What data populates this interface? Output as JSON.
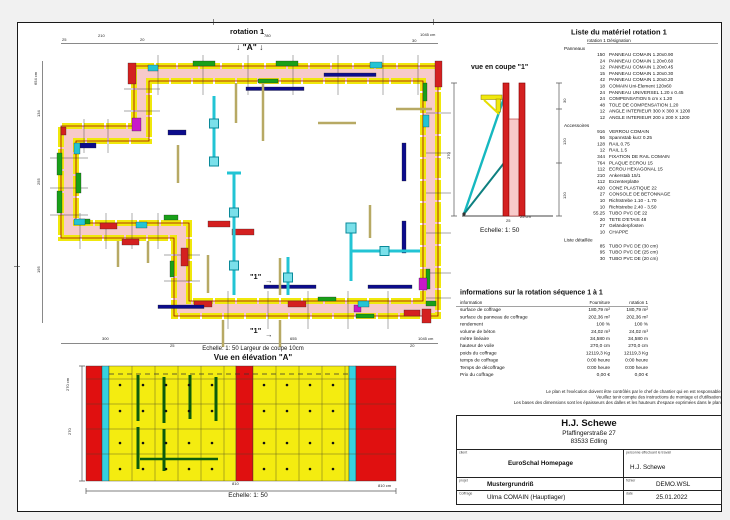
{
  "plan": {
    "title": "rotation 1",
    "marker_a": "↓ \"A\" ↓",
    "cut_marker": "\"1\"",
    "cut_arrow": "→",
    "dims_top": [
      "25",
      "210",
      "20",
      "780",
      "30"
    ],
    "dims_top_total": "1045 cm",
    "dims_left": [
      "134",
      "255",
      "195"
    ],
    "dims_left_total": "654 cm",
    "dims_bottom": [
      "300",
      "25",
      "655",
      "20"
    ],
    "dims_bottom_total": "1045 cm",
    "caption": "Echelle: 1: 50   Largeur de coupe 10cm"
  },
  "section_view": {
    "title": "vue en coupe \"1\"",
    "dims_right": [
      "30",
      "120",
      "120"
    ],
    "dim_left": "270",
    "dim_width": "25",
    "dim_width_label": "25 cm",
    "scale": "Echelle: 1: 50"
  },
  "elevation": {
    "title": "Vue en élévation \"A\"",
    "dim_left_label": "270 cm",
    "dim_left": "270",
    "dim_bottom": "810",
    "dim_bottom_label": "810 cm",
    "scale": "Echelle: 1: 50"
  },
  "material_list": {
    "title": "Liste du matériel  rotation 1",
    "header": "rotation 1   Désignation",
    "sections": [
      {
        "name": "Panneaux",
        "items": [
          [
            "150",
            "PANNEAU COMAIN 1.20x0.90"
          ],
          [
            "24",
            "PANNEAU COMAIN 1.20x0.60"
          ],
          [
            "12",
            "PANNEAU COMAIN 1.20x0.45"
          ],
          [
            "15",
            "PANNEAU COMAIN 1.20x0.30"
          ],
          [
            "42",
            "PANNEAU COMAIN 1.20x0.20"
          ],
          [
            "18",
            "COMAIN Uni-Element 120x60"
          ],
          [
            "24",
            "PANNEAU UNIVERSEL 1.20 x 0.45"
          ],
          [
            "24",
            "COMPENSATION 5 cm x 1.20"
          ],
          [
            "48",
            "TOLE DE COMPENSATION 1.20"
          ],
          [
            "12",
            "ANGLE INTERIEUR 300 X 300 X 1200"
          ],
          [
            "12",
            "ANGLE INTERIEUR 200 x 200 X 1200"
          ]
        ]
      },
      {
        "name": "Accessoires",
        "items": [
          [
            "916",
            "VERROU COMAIN"
          ],
          [
            "56",
            "Spannstab kurz 0.25"
          ],
          [
            "128",
            "RAIL 0.75"
          ],
          [
            "12",
            "RAIL 1.5"
          ],
          [
            "344",
            "FIXATION DE RAIL COMAIN"
          ],
          [
            "764",
            "PLAQUE ECROU 15"
          ],
          [
            "112",
            "ECROU HEXAGONAL 15"
          ],
          [
            "210",
            "Ankerstab 15/1"
          ],
          [
            "112",
            "Exzenterplatte"
          ],
          [
            "420",
            "CONE PLASTIQUE 22"
          ],
          [
            "27",
            "CONSOLE DE BETONNAGE"
          ],
          [
            "10",
            "Richtstrebe 1.10 - 1.70"
          ],
          [
            "10",
            "Richtstrebe 2.40 - 3.50"
          ],
          [
            "55.25",
            "TUBO PVC DE 22"
          ],
          [
            "20",
            "TETE D'ETAIS 48"
          ],
          [
            "27",
            "Geländerpfosten"
          ],
          [
            "10",
            "CHAPPE"
          ]
        ]
      },
      {
        "name": "Liste détaillée",
        "items": [
          [
            "85",
            "TUBO PVC DE  (30 cm)"
          ],
          [
            "95",
            "TUBO PVC DE  (25 cm)"
          ],
          [
            "30",
            "TUBO PVC DE  (20 cm)"
          ]
        ]
      }
    ]
  },
  "info_table": {
    "title": "informations sur la rotation  séquence 1 à 1",
    "columns": [
      "information",
      "Fourniture",
      "rotation 1"
    ],
    "rows": [
      [
        "surface de coffrage",
        "180,79 m²",
        "180,79 m²"
      ],
      [
        "surface du panneau de coffrage",
        "202,36 m²",
        "202,36 m²"
      ],
      [
        "rendement",
        "100 %",
        "100 %"
      ],
      [
        "volume de béton",
        "24,02 m³",
        "24,02 m³"
      ],
      [
        "mètre linéaire",
        "34,580 m",
        "34,580 m"
      ],
      [
        "hauteur de voile",
        "270,0 cm",
        "270,0 cm"
      ],
      [
        "poids du coffrage",
        "12119,3 Kg",
        "12119,3 Kg"
      ],
      [
        "temps de coffrage",
        "0:00 heure",
        "0:00 heure"
      ],
      [
        "Temps de décoffrage",
        "0:00 heure",
        "0:00 heure"
      ],
      [
        "Prix du coffrage",
        "0,00 €",
        "0,00 €"
      ]
    ]
  },
  "disclaimer": {
    "lines": [
      "Le plan et l'exécution doivent être contrôlés par le chef de chantier qui en est responsable!",
      "Veuillez tenir compte des instructions de montage et d'utilisation!",
      "Les bases des dimensions sont les épaisseurs des dalles et les hauteurs d'espace exprimées dans le plan."
    ]
  },
  "title_block": {
    "company": "H.J. Schewe",
    "street": "Pfaffingerstraße 27",
    "city": "83533 Edling",
    "client_label": "client",
    "client": "EuroSchal Homepage",
    "worker_label": "personne effectuant le travail",
    "worker": "H.J. Schewe",
    "project_label": "projet",
    "project": "Mustergrundriß",
    "file_label": "fichier",
    "file": "DEMO.WSL",
    "formwork_label": "Coffrage",
    "formwork": "Ulma COMAIN (Hauptlager)",
    "date_label": "date",
    "date": "25.01.2022"
  },
  "colors": {
    "wall_fill": "#f7caca",
    "panel_yellow": "#f0e80c",
    "accent_red": "#d42020",
    "accent_green": "#18a018",
    "accent_blue": "#0c0c8c",
    "accent_magenta": "#c818c8",
    "accent_cyan": "#22c4d4",
    "prop_tan": "#b7a964"
  }
}
